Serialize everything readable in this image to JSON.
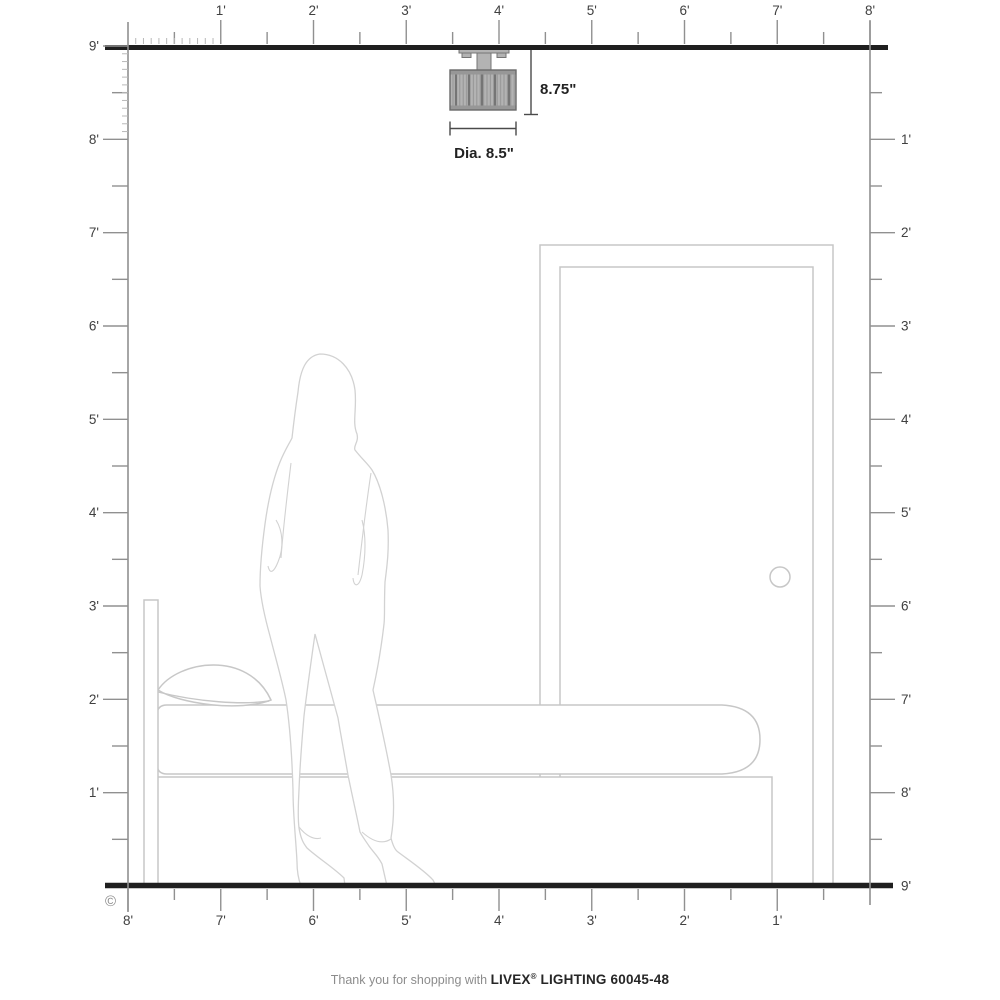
{
  "rulers": {
    "top_labels": [
      "1'",
      "2'",
      "3'",
      "4'",
      "5'",
      "6'",
      "7'",
      "8'"
    ],
    "bottom_labels": [
      "8'",
      "7'",
      "6'",
      "5'",
      "4'",
      "3'",
      "2'",
      "1'"
    ],
    "left_labels": [
      "9'",
      "8'",
      "7'",
      "6'",
      "5'",
      "4'",
      "3'",
      "2'",
      "1'"
    ],
    "right_labels": [
      "1'",
      "2'",
      "3'",
      "4'",
      "5'",
      "6'",
      "7'",
      "8'"
    ],
    "right_floor_label": "9'"
  },
  "fixture": {
    "height_dimension": "8.75\"",
    "diameter_dimension": "Dia. 8.5\""
  },
  "copyright_symbol": "©",
  "footer": {
    "prefix": "Thank you for shopping with",
    "brand": "LIVEX",
    "registered_mark": "®",
    "product": "LIGHTING 60045-48"
  },
  "colors": {
    "wall": "#1f1f1f",
    "ruler": "#909090",
    "ruler_minor": "#b8b8b8",
    "tick_label": "#404040",
    "furniture_outline": "#c7c7c7",
    "figure_outline": "#d2d2d2",
    "dimension_line": "#4a4a4a",
    "dimension_text": "#222222",
    "fixture_base": "#b3b3b3",
    "fixture_stripe": "#949494",
    "fixture_dark": "#757575",
    "footer_text": "#8c8c8c",
    "footer_brand": "#262626"
  }
}
